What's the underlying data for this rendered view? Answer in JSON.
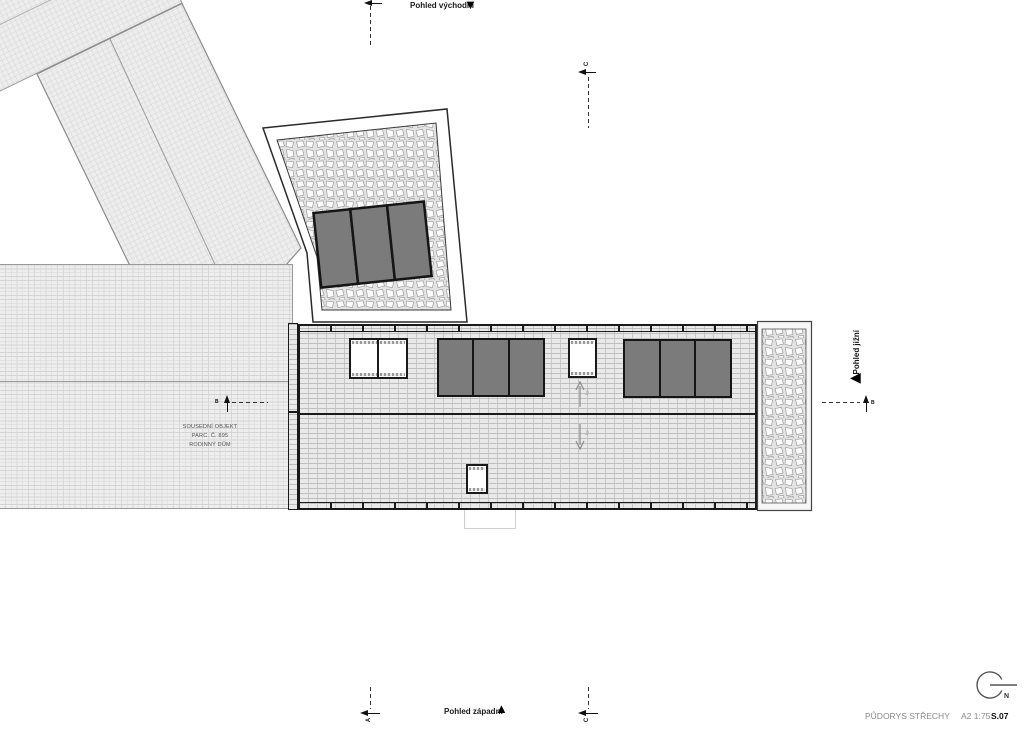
{
  "views": {
    "east": {
      "label": "Pohled východní"
    },
    "west": {
      "label": "Pohled západní"
    },
    "south": {
      "label": "Pohled jižní"
    }
  },
  "icons": {
    "triangle_down": "▼",
    "triangle_up": "▲",
    "triangle_left": "◀"
  },
  "sections": {
    "a": "A",
    "b": "B",
    "c": "C"
  },
  "neighbor_label": {
    "line1": "SOUSEDNÍ OBJEKT",
    "line2": "PARC. Č. 895",
    "line3": "RODINNÝ DŮM"
  },
  "slope": {
    "upper": "10°",
    "lower": "10°"
  },
  "compass": {
    "label": "N"
  },
  "title_block": {
    "drawing_title": "PŮDORYS STŘECHY",
    "format_scale": "A2 1:75",
    "sheet_number": "S.07"
  },
  "colors": {
    "solar_panel": "#7b7b7b",
    "roof_line": "#1a1a1a",
    "muted_text": "#8a8a8a",
    "hatch_bg": "#e9e9e9"
  }
}
